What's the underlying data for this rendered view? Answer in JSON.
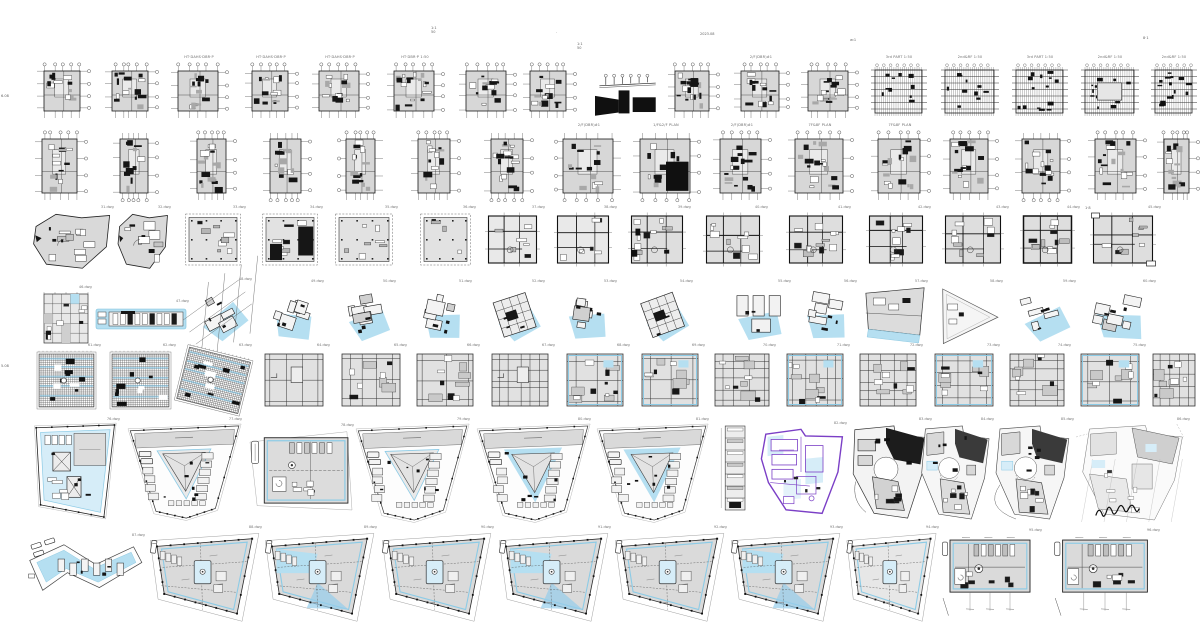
{
  "canvas": {
    "width": 1200,
    "height": 644,
    "background": "#ffffff",
    "description": "architectural floor plan thumbnail grid"
  },
  "palette": {
    "ink": "#1a1a1a",
    "wall": "#111111",
    "gray_fill": "#d7d7d7",
    "light_fill": "#e6e6e6",
    "blue": "#b5dff1",
    "blue_light": "#d6edf8",
    "blue_line": "#8ccbe6",
    "purple": "#7b3fc6",
    "bubble_stroke": "#555555"
  },
  "annotations": [
    {
      "x": 431,
      "y": 26,
      "text": "1:1\n50"
    },
    {
      "x": 556,
      "y": 31,
      "text": "·"
    },
    {
      "x": 577,
      "y": 42,
      "text": "1:1\n50"
    },
    {
      "x": 700,
      "y": 32,
      "text": "2023.08"
    },
    {
      "x": 850,
      "y": 38,
      "text": "w:1"
    },
    {
      "x": 1,
      "y": 94,
      "text": "6.08"
    },
    {
      "x": 1,
      "y": 364,
      "text": "5.08"
    },
    {
      "x": 1143,
      "y": 36,
      "text": "8·1"
    },
    {
      "x": 1085,
      "y": 206,
      "text": "1·8"
    }
  ],
  "scribble": {
    "x": 1094,
    "y": 504,
    "w": 46,
    "h": 16
  },
  "rows": [
    {
      "name": "row-1-structural-plans",
      "y": 62,
      "h": 58,
      "plans": [
        {
          "x": 35,
          "w": 56,
          "style": "grid-dark"
        },
        {
          "x": 103,
          "w": 56,
          "style": "grid-dark"
        },
        {
          "x": 169,
          "w": 60,
          "style": "grid-dark",
          "caption": "HT·DAHS·DBR·P"
        },
        {
          "x": 243,
          "w": 56,
          "style": "grid-dark",
          "caption": "HT·DAHS·DBR·P"
        },
        {
          "x": 310,
          "w": 60,
          "style": "grid-dark",
          "caption": "HT·DAHS·DBR·P"
        },
        {
          "x": 385,
          "w": 60,
          "style": "grid-dark",
          "caption": "HT·DBR·P 1:50"
        },
        {
          "x": 457,
          "w": 60,
          "style": "grid-dark"
        },
        {
          "x": 521,
          "w": 56,
          "style": "grid-dark"
        },
        {
          "x": 593,
          "w": 64,
          "y": 72,
          "h": 46,
          "style": "elevation"
        },
        {
          "x": 666,
          "w": 54,
          "style": "grid-dark"
        },
        {
          "x": 732,
          "w": 58,
          "style": "grid-dark",
          "caption": "2/F(DBR)#1"
        },
        {
          "x": 799,
          "w": 60,
          "style": "grid-dark"
        },
        {
          "x": 869,
          "w": 60,
          "style": "grid-struct",
          "caption": "3rd PART 1:50"
        },
        {
          "x": 939,
          "w": 62,
          "style": "grid-struct",
          "caption": "2nd&RF 1:50"
        },
        {
          "x": 1010,
          "w": 60,
          "style": "grid-struct",
          "caption": "3rd PART 1:50"
        },
        {
          "x": 1079,
          "w": 62,
          "style": "grid-struct",
          "caption": "2nd&RF 1:50",
          "variant": {
            "rooms": true
          }
        },
        {
          "x": 1149,
          "w": 50,
          "style": "grid-struct",
          "caption": "2nd&RF 1:50"
        }
      ]
    },
    {
      "name": "row-2-floor-plans",
      "y": 130,
      "h": 72,
      "plans": [
        {
          "x": 33,
          "w": 55,
          "style": "grid-dark",
          "variant": {
            "bubbles": "top-right"
          }
        },
        {
          "x": 111,
          "w": 48,
          "style": "grid-dark",
          "variant": {
            "bubbles": "bottom-right"
          }
        },
        {
          "x": 188,
          "w": 49,
          "style": "grid-dark",
          "variant": {
            "bubbles": "top-right"
          }
        },
        {
          "x": 261,
          "w": 51,
          "style": "grid-dark",
          "variant": {
            "bubbles": "bottom-right"
          }
        },
        {
          "x": 337,
          "w": 49,
          "style": "grid-dark",
          "variant": {
            "bubbles": "top-left"
          }
        },
        {
          "x": 409,
          "w": 52,
          "style": "grid-dark",
          "variant": {
            "bubbles": "top-right"
          }
        },
        {
          "x": 482,
          "w": 52,
          "style": "grid-dark",
          "variant": {
            "bubbles": "bottom-right"
          }
        },
        {
          "x": 554,
          "w": 70,
          "style": "grid-dark",
          "caption": "2/F(DBR)#1",
          "variant": {
            "bubbles": "bottom-left"
          }
        },
        {
          "x": 631,
          "w": 70,
          "style": "grid-dark",
          "caption": "1/F&2/F PLAN",
          "variant": {
            "bubbles": "bottom-right",
            "dark": true
          }
        },
        {
          "x": 711,
          "w": 61,
          "style": "grid-dark",
          "caption": "2/F(DBR)#1",
          "variant": {
            "bubbles": "top-right"
          }
        },
        {
          "x": 786,
          "w": 68,
          "style": "grid-dark",
          "caption": "7F&8F PLAN",
          "variant": {
            "bubbles": "top-right"
          }
        },
        {
          "x": 869,
          "w": 62,
          "style": "grid-dark",
          "caption": "7F&8F PLAN",
          "variant": {
            "bubbles": "top-right"
          }
        },
        {
          "x": 941,
          "w": 58,
          "style": "grid-dark",
          "variant": {
            "bubbles": "top-right"
          }
        },
        {
          "x": 1013,
          "w": 58,
          "style": "grid-dark",
          "variant": {
            "bubbles": "bottom-right"
          }
        },
        {
          "x": 1086,
          "w": 61,
          "style": "grid-dark",
          "variant": {
            "bubbles": "top-right"
          }
        },
        {
          "x": 1155,
          "w": 45,
          "style": "grid-dark",
          "variant": {
            "bubbles": "top-right"
          }
        }
      ]
    },
    {
      "name": "row-3-unit-plans",
      "y": 212,
      "h": 58,
      "plans": [
        {
          "x": 32,
          "w": 80,
          "style": "poly-gray",
          "tag": "31.dwg"
        },
        {
          "x": 117,
          "w": 52,
          "style": "poly-gray",
          "tag": "32.dwg"
        },
        {
          "x": 184,
          "w": 60,
          "style": "rect-dashed",
          "tag": "33.dwg"
        },
        {
          "x": 261,
          "w": 60,
          "style": "rect-dashed",
          "variant": {
            "dark": true
          },
          "tag": "34.dwg"
        },
        {
          "x": 334,
          "w": 62,
          "style": "rect-dashed",
          "tag": "35.dwg"
        },
        {
          "x": 419,
          "w": 55,
          "style": "rect-dashed",
          "variant": {
            "sparse": true
          },
          "tag": "36.dwg"
        },
        {
          "x": 486,
          "w": 57,
          "style": "room-plan",
          "variant": {
            "sparse": true
          },
          "tag": "37.dwg"
        },
        {
          "x": 555,
          "w": 60,
          "style": "room-plan",
          "variant": {
            "sparse": true
          },
          "tag": "38.dwg"
        },
        {
          "x": 629,
          "w": 60,
          "style": "room-plan",
          "variant": {
            "dark": true
          },
          "tag": "39.dwg"
        },
        {
          "x": 704,
          "w": 62,
          "style": "room-plan",
          "tag": "40.dwg"
        },
        {
          "x": 787,
          "w": 62,
          "style": "room-plan",
          "tag": "41.dwg"
        },
        {
          "x": 867,
          "w": 62,
          "style": "room-plan",
          "tag": "42.dwg"
        },
        {
          "x": 943,
          "w": 64,
          "style": "room-plan",
          "tag": "43.dwg"
        },
        {
          "x": 1021,
          "w": 57,
          "style": "room-plan",
          "variant": {
            "bold": true
          },
          "tag": "44.dwg"
        },
        {
          "x": 1091,
          "w": 68,
          "style": "room-plan",
          "variant": {
            "wings": true
          },
          "tag": "45.dwg"
        }
      ]
    },
    {
      "name": "row-4-blue-cluster-plans",
      "y": 286,
      "h": 60,
      "plans": [
        {
          "x": 42,
          "w": 48,
          "y": 292,
          "h": 53,
          "style": "small-grid",
          "tag": "46.dwg"
        },
        {
          "x": 95,
          "w": 92,
          "y": 306,
          "h": 26,
          "style": "blue-strip",
          "tag": "47.dwg"
        },
        {
          "x": 188,
          "w": 62,
          "y": 284,
          "h": 62,
          "style": "blue-cluster",
          "rot": -28,
          "variant": {
            "grid": true
          },
          "tag": "48.dwg"
        },
        {
          "x": 266,
          "w": 56,
          "style": "blue-cluster",
          "rot": 18,
          "tag": "49.dwg"
        },
        {
          "x": 338,
          "w": 56,
          "style": "blue-cluster",
          "rot": -10,
          "tag": "50.dwg"
        },
        {
          "x": 416,
          "w": 54,
          "style": "blue-cluster",
          "rot": 12,
          "tag": "51.dwg"
        },
        {
          "x": 487,
          "w": 56,
          "style": "blue-cluster",
          "rot": -18,
          "variant": {
            "square": true
          },
          "tag": "52.dwg"
        },
        {
          "x": 559,
          "w": 56,
          "style": "blue-cluster",
          "rot": 8,
          "tag": "53.dwg"
        },
        {
          "x": 635,
          "w": 56,
          "style": "blue-cluster",
          "rot": -20,
          "variant": {
            "square": true
          },
          "tag": "54.dwg"
        },
        {
          "x": 727,
          "w": 62,
          "style": "blue-cluster",
          "rot": 0,
          "variant": {
            "rects3": true
          },
          "tag": "55.dwg"
        },
        {
          "x": 797,
          "w": 58,
          "style": "blue-cluster",
          "rot": 10,
          "tag": "56.dwg"
        },
        {
          "x": 864,
          "w": 62,
          "style": "blue-trap",
          "tag": "57.dwg"
        },
        {
          "x": 939,
          "w": 62,
          "style": "tri-outline",
          "tag": "58.dwg"
        },
        {
          "x": 1012,
          "w": 62,
          "style": "blue-cluster",
          "rot": -15,
          "tag": "59.dwg"
        },
        {
          "x": 1084,
          "w": 70,
          "style": "blue-cluster",
          "rot": 12,
          "tag": "60.dwg"
        }
      ]
    },
    {
      "name": "row-5-grid-squares",
      "y": 350,
      "h": 62,
      "plans": [
        {
          "x": 35,
          "w": 64,
          "style": "hatch-sq",
          "variant": {
            "blue": true
          },
          "tag": "61.dwg"
        },
        {
          "x": 108,
          "w": 66,
          "style": "hatch-sq",
          "variant": {
            "blue": true
          },
          "tag": "62.dwg"
        },
        {
          "x": 178,
          "w": 72,
          "style": "hatch-sq",
          "rot": 14,
          "variant": {
            "blue": true
          },
          "tag": "63.dwg"
        },
        {
          "x": 262,
          "w": 66,
          "style": "grid-sq",
          "variant": {
            "plain": true
          },
          "tag": "64.dwg"
        },
        {
          "x": 339,
          "w": 66,
          "style": "grid-sq",
          "tag": "65.dwg"
        },
        {
          "x": 414,
          "w": 64,
          "style": "grid-sq",
          "variant": {
            "dark": true
          },
          "tag": "66.dwg"
        },
        {
          "x": 489,
          "w": 64,
          "style": "grid-sq",
          "variant": {
            "plain": true
          },
          "tag": "67.dwg"
        },
        {
          "x": 564,
          "w": 64,
          "style": "grid-sq",
          "variant": {
            "dark": true,
            "blue": true
          },
          "tag": "68.dwg"
        },
        {
          "x": 639,
          "w": 64,
          "style": "grid-sq",
          "variant": {
            "blue": true
          },
          "tag": "69.dwg"
        },
        {
          "x": 712,
          "w": 62,
          "style": "grid-sq",
          "tag": "70.dwg"
        },
        {
          "x": 784,
          "w": 64,
          "style": "grid-sq",
          "variant": {
            "blue": true
          },
          "tag": "71.dwg"
        },
        {
          "x": 857,
          "w": 64,
          "style": "grid-sq",
          "tag": "72.dwg"
        },
        {
          "x": 932,
          "w": 66,
          "style": "grid-sq",
          "variant": {
            "blue": true
          },
          "tag": "73.dwg"
        },
        {
          "x": 1007,
          "w": 62,
          "style": "grid-sq",
          "tag": "74.dwg"
        },
        {
          "x": 1078,
          "w": 66,
          "style": "grid-sq",
          "variant": {
            "blue": true
          },
          "tag": "75.dwg"
        },
        {
          "x": 1150,
          "w": 50,
          "style": "grid-sq"
        }
      ]
    },
    {
      "name": "row-6-large-site-plans",
      "y": 424,
      "h": 96,
      "plans": [
        {
          "x": 30,
          "w": 88,
          "h": 94,
          "style": "big-trap-x",
          "tag": "76.dwg"
        },
        {
          "x": 128,
          "w": 112,
          "h": 96,
          "style": "big-trap-tri",
          "tag": "77.dwg"
        },
        {
          "x": 250,
          "w": 102,
          "y": 430,
          "h": 86,
          "style": "mech-rect",
          "tag": "78.dwg"
        },
        {
          "x": 356,
          "w": 112,
          "h": 98,
          "style": "big-trap-tri",
          "tag": "79.dwg"
        },
        {
          "x": 477,
          "w": 112,
          "h": 98,
          "style": "big-trap-tri",
          "variant": {
            "blue": true
          },
          "tag": "80.dwg"
        },
        {
          "x": 597,
          "w": 110,
          "h": 98,
          "style": "big-trap-tri",
          "variant": {
            "blue": true
          },
          "tag": "81.dwg"
        },
        {
          "x": 712,
          "w": 44,
          "h": 92,
          "style": "thin-strip"
        },
        {
          "x": 757,
          "w": 88,
          "y": 428,
          "h": 88,
          "style": "purple-plan",
          "tag": "82.dwg"
        },
        {
          "x": 850,
          "w": 80,
          "h": 96,
          "style": "dark-irregular",
          "tag": "83.dwg"
        },
        {
          "x": 918,
          "w": 74,
          "h": 98,
          "style": "circle-irregular",
          "tag": "84.dwg"
        },
        {
          "x": 992,
          "w": 80,
          "h": 98,
          "style": "circle-irregular",
          "variant": {
            "arc": true
          },
          "tag": "85.dwg"
        },
        {
          "x": 1076,
          "w": 112,
          "h": 100,
          "style": "light-irregular",
          "tag": "86.dwg"
        }
      ]
    },
    {
      "name": "row-7-lower-floor-plans",
      "y": 532,
      "h": 96,
      "plans": [
        {
          "x": 25,
          "w": 118,
          "y": 540,
          "h": 68,
          "style": "chevron",
          "tag": "87.dwg"
        },
        {
          "x": 148,
          "w": 112,
          "style": "trap-rooms",
          "tag": "88.dwg"
        },
        {
          "x": 263,
          "w": 112,
          "style": "trap-rooms",
          "variant": {
            "blue": true
          },
          "tag": "89.dwg"
        },
        {
          "x": 380,
          "w": 112,
          "style": "trap-rooms",
          "tag": "90.dwg"
        },
        {
          "x": 497,
          "w": 112,
          "style": "trap-rooms",
          "variant": {
            "blue": true
          },
          "tag": "91.dwg"
        },
        {
          "x": 613,
          "w": 112,
          "style": "trap-rooms",
          "tag": "92.dwg"
        },
        {
          "x": 729,
          "w": 112,
          "style": "trap-rooms",
          "variant": {
            "blue": true
          },
          "tag": "93.dwg"
        },
        {
          "x": 845,
          "w": 92,
          "style": "trap-rooms",
          "variant": {
            "light": true
          },
          "tag": "94.dwg"
        },
        {
          "x": 940,
          "w": 100,
          "y": 535,
          "h": 84,
          "style": "mech-rect2",
          "tag": "95.dwg"
        },
        {
          "x": 1052,
          "w": 106,
          "y": 535,
          "h": 84,
          "style": "mech-rect2",
          "tag": "96.dwg"
        }
      ]
    }
  ]
}
